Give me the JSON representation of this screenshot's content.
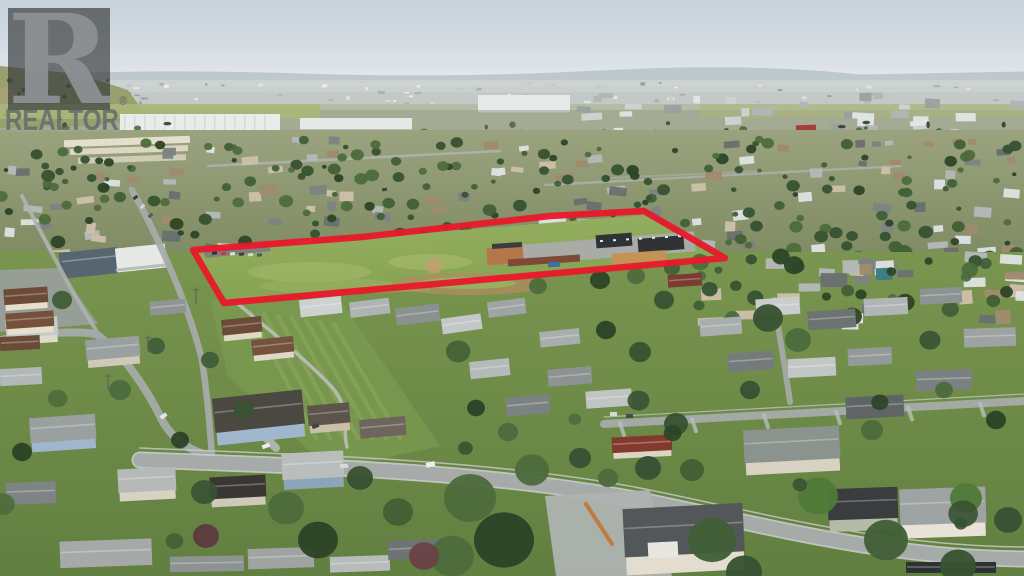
{
  "meta": {
    "description": "Aerial drone photograph of a suburban residential neighbourhood with a commercial/school parcel outlined in red",
    "overlay_type": "property boundary outline"
  },
  "watermark": {
    "symbol": "R",
    "brand": "REALTOR",
    "registered": "®"
  },
  "boundary": {
    "points": "193,250 362,237 550,216 644,211 725,258 224,303",
    "color": "#e81a2b",
    "stroke_width": 6.5
  },
  "palette": {
    "sky_top": "#c6d1d9",
    "sky_bottom": "#e7ecef",
    "ridge": "#b2bfc3",
    "haze": "#ccd3d1",
    "hill": "#98a06e",
    "field_far": "#a9b778",
    "warehouse": "#e9eceb",
    "mid_top": "#9aa37e",
    "mid_bottom": "#7e8a62",
    "fore_top": "#79954f",
    "fore_bottom": "#617f40",
    "parcel_light": "#97b162",
    "parcel_dark": "#84a251",
    "dirt": "#b08c5f",
    "road": "#a6abaa",
    "road_edge": "#c9cdcc",
    "path": "#b9bdb4",
    "trees": [
      "#2c4426",
      "#375232",
      "#425f37",
      "#4d6b3c"
    ],
    "tree_red": "#5d3a40",
    "roofs": [
      "#dde1e0",
      "#b3b9b8",
      "#7d8382",
      "#a08a6e",
      "#cbbfa8",
      "#6a706f"
    ],
    "school_dark": "#303335",
    "school_gray": "#a9aba7",
    "school_orange": "#b5764a",
    "school_maroon": "#7d4a38",
    "hall_blue": "#56656f",
    "hall_white": "#e7e9e7",
    "apartment": "#e4dfcd",
    "house_wall_blue": "#9fb6cc",
    "fence_orange": "#c2763c",
    "car_white": "#eceeed"
  }
}
